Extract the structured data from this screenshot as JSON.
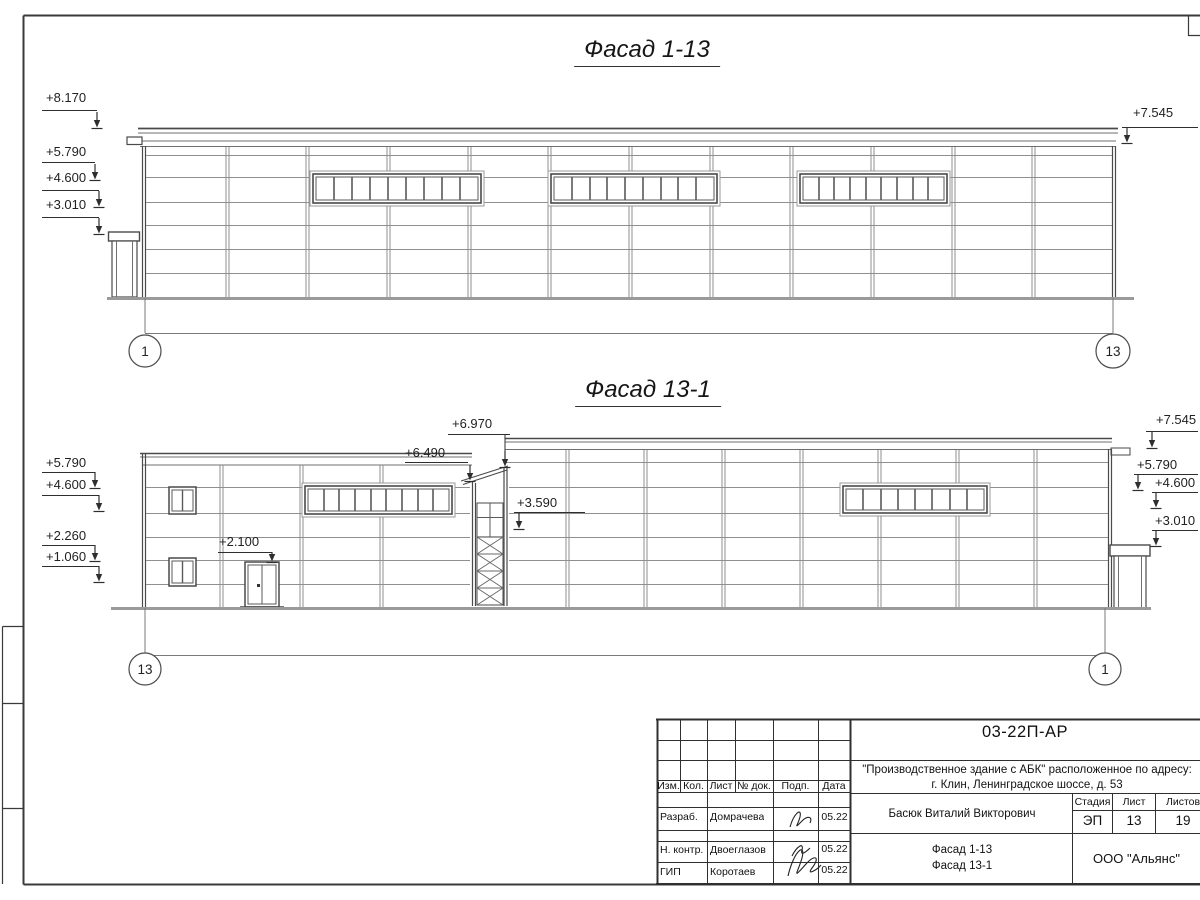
{
  "facade1": {
    "title": "Фасад 1-13",
    "left_marks": [
      "+8.170",
      "+5.790",
      "+4.600",
      "+3.010"
    ],
    "right_mark": "+7.545",
    "axis_left": "1",
    "axis_right": "13"
  },
  "facade2": {
    "title": "Фасад 13-1",
    "left_marks": [
      "+5.790",
      "+4.600",
      "+2.260",
      "+1.060"
    ],
    "right_marks": [
      "+7.545",
      "+5.790",
      "+4.600",
      "+3.010"
    ],
    "mark_tower_top": "+6.970",
    "mark_canopy": "+6.490",
    "mark_landing": "+3.590",
    "mark_door": "+2.100",
    "axis_left": "13",
    "axis_right": "1"
  },
  "title_block": {
    "doc_number": "03-22П-АР",
    "project_line1": "\"Производственное здание с АБК\" расположенное по адресу:",
    "project_line2": "г. Клин, Ленинградское шоссе, д. 53",
    "header_cols": [
      "Изм.",
      "Кол.",
      "Лист",
      "№ док.",
      "Подп.",
      "Дата"
    ],
    "rows": [
      {
        "role": "Разраб.",
        "name": "Домрачева",
        "date": "05.22"
      },
      {
        "role": "Н. контр.",
        "name": "Двоеглазов",
        "date": "05.22"
      },
      {
        "role": "ГИП",
        "name": "Коротаев",
        "date": "05.22"
      }
    ],
    "supervisor": "Басюк Виталий Викторович",
    "stage_label": "Стадия",
    "stage_value": "ЭП",
    "sheet_label": "Лист",
    "sheet_value": "13",
    "total_label": "Листов",
    "total_value": "19",
    "drawing_name_line1": "Фасад 1-13",
    "drawing_name_line2": "Фасад 13-1",
    "company": "ООО \"Альянс\""
  }
}
